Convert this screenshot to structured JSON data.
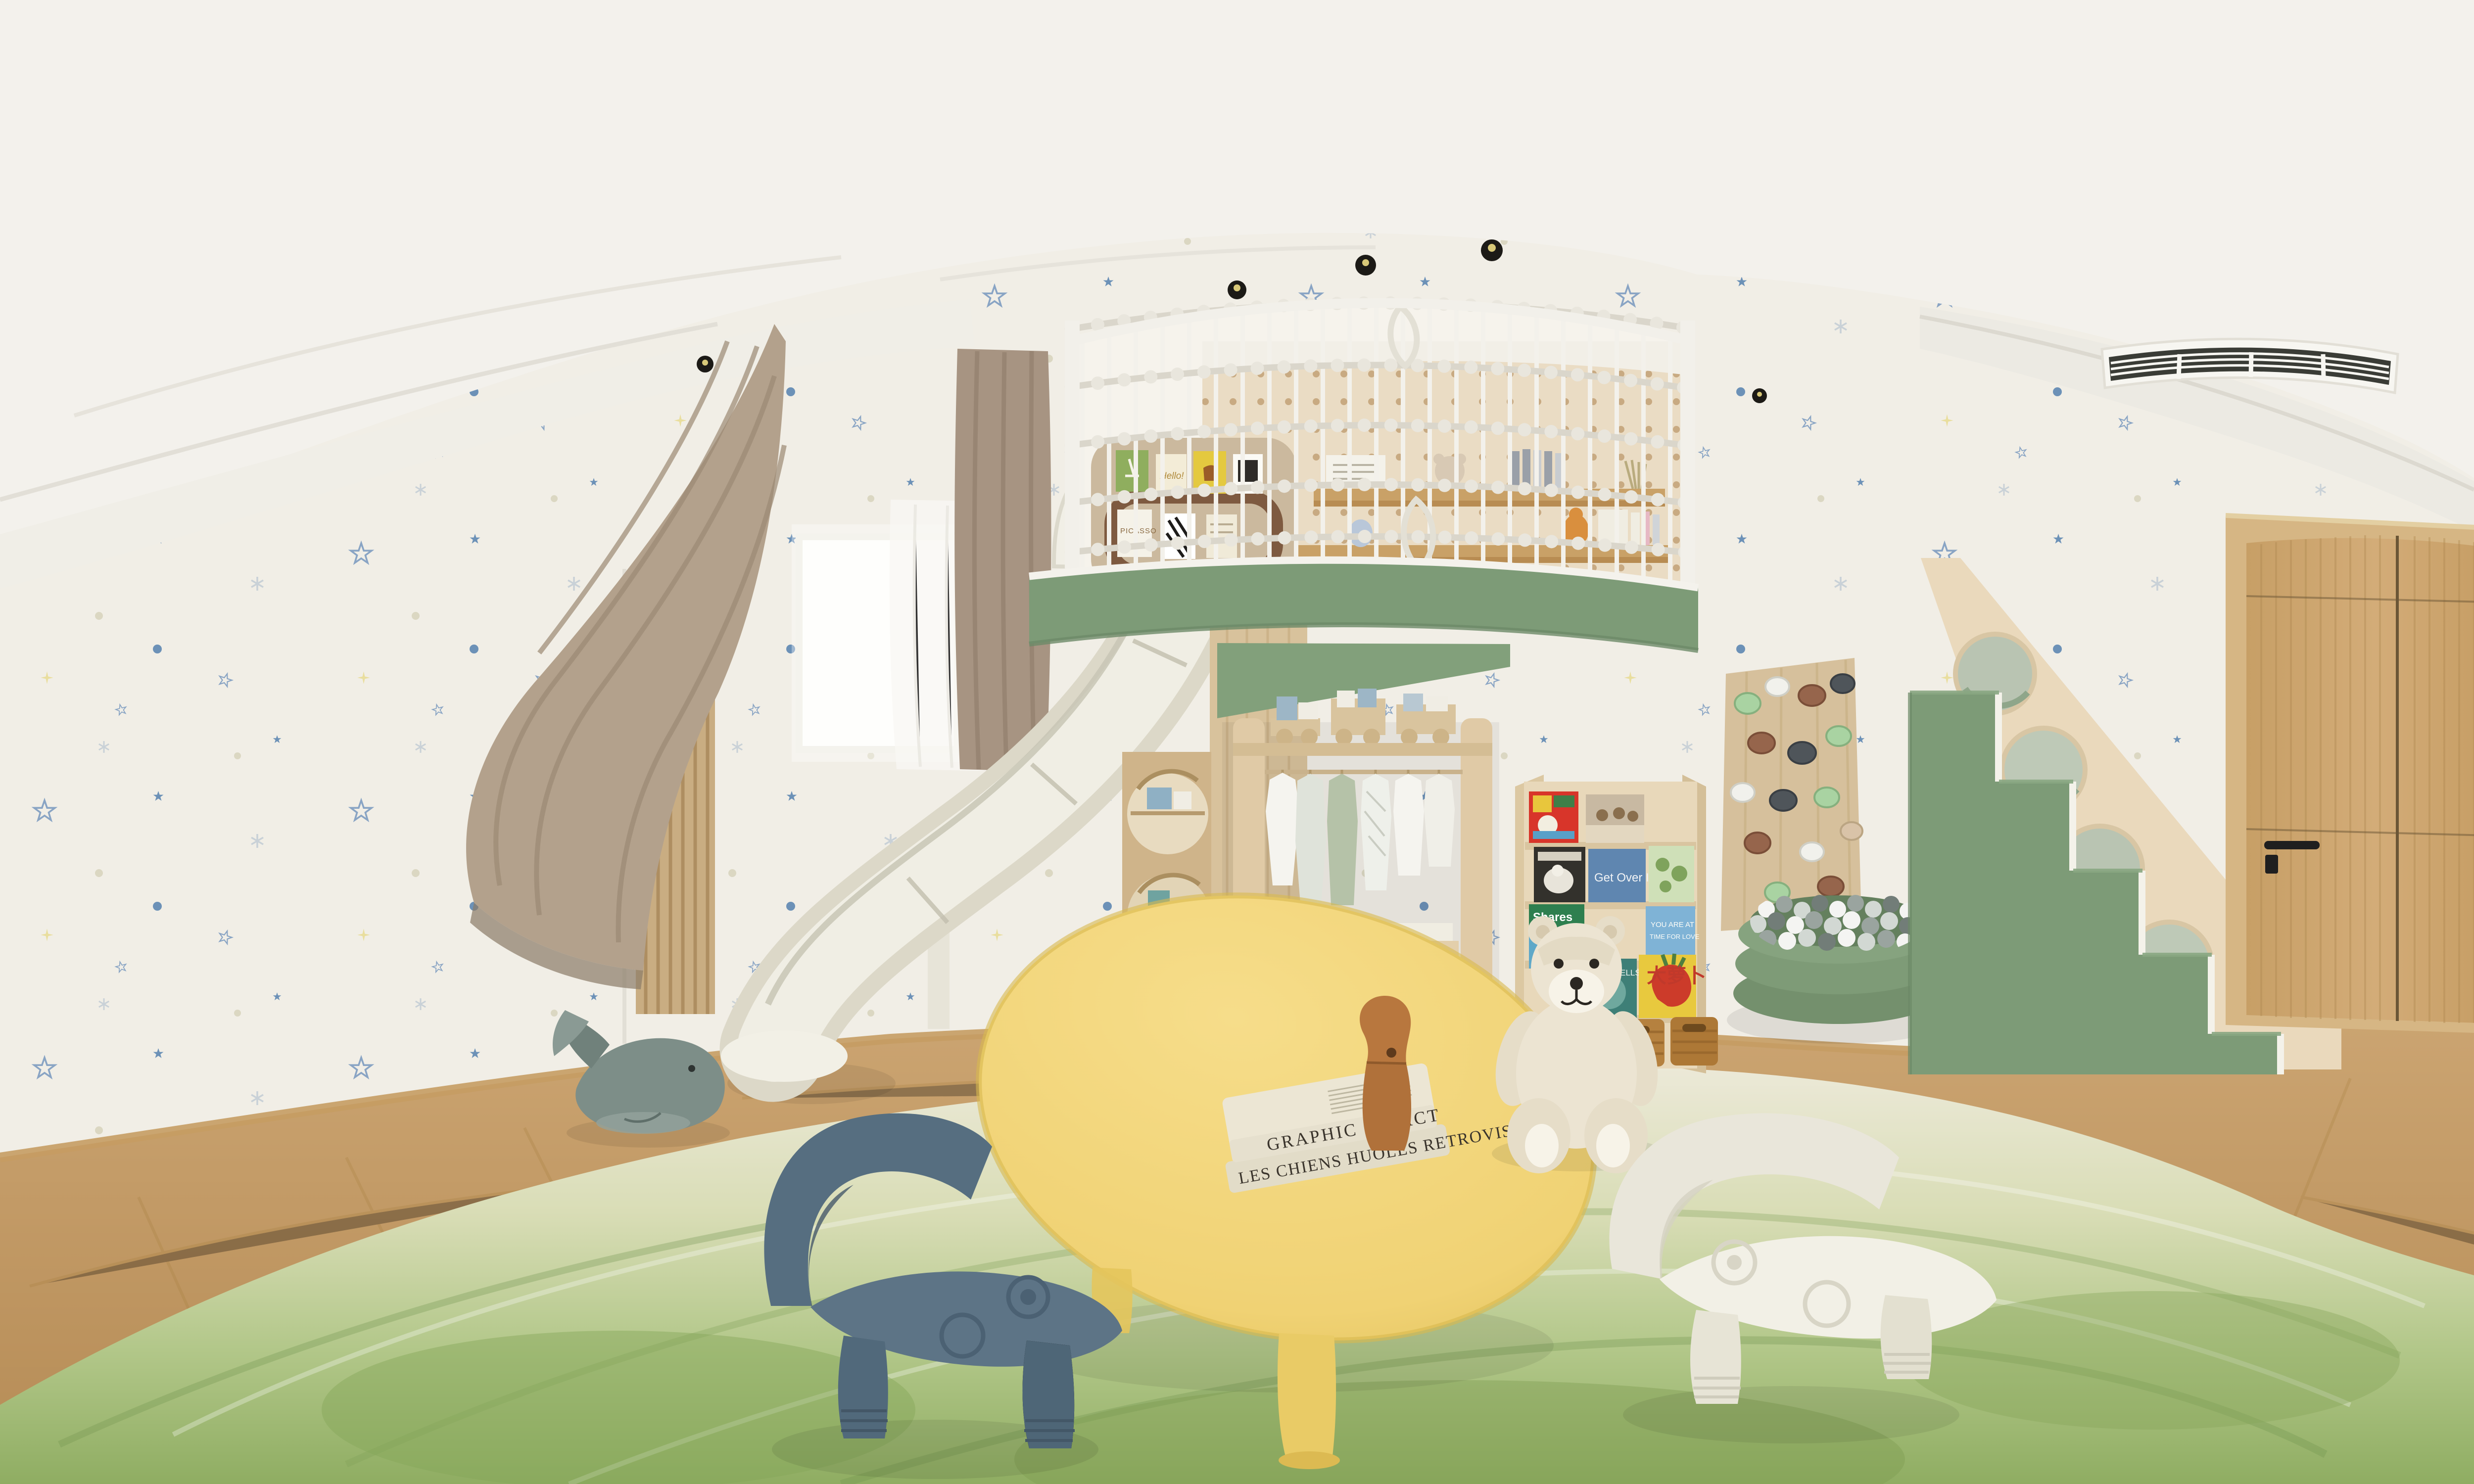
{
  "scene": {
    "kind": "equirectangular-360-panorama-render",
    "room": "children-playroom",
    "description": "360-degree render of a kids playroom: star wallpaper, loft play structure with rope-net railing, white slide, sage-green platform and staircase with porthole panel, open wardrobe with toy train, book display shelf, climbing wall, green ball pit, teddy bear, yellow play table with books, blue and white toddler chairs, green gradient rug, taupe curtains, window, oak door, ceiling AC grille and recessed spotlights"
  },
  "palette": {
    "ceiling": "#f3f1ec",
    "wall": "#f1eee6",
    "cove_band": "#f0eee7",
    "bulkhead": "#eceae3",
    "star_blue_outline": "#7d9cc0",
    "star_blue_solid": "#5d87b2",
    "star_gray": "#c5ced5",
    "star_yellow": "#e8dc96",
    "dot_beige": "#d9d4be",
    "floor_wood": "#c49a66",
    "floor_plank_line": "#a8803f",
    "baseboard": "#c59c63",
    "rug_cream": "#ece9d8",
    "rug_green": "#93b168",
    "sage_green": "#7d9b77",
    "sage_green_dark": "#6d8a68",
    "plywood": "#e8d9bc",
    "wood_furniture": "#e0caa6",
    "pegboard": "#eadcc4",
    "slide_white": "#efede3",
    "curtain_taupe": "#b3a18c",
    "sheer_white": "#f8f7f3",
    "door_oak": "#cfa873",
    "table_yellow": "#f0d274",
    "chair_blue": "#5d7486",
    "chair_white": "#f0eee4",
    "teddy_cream": "#ece4d2",
    "whale_gray_green": "#7d8e88",
    "wicker": "#b5813f",
    "vent_slat": "#3a3c36",
    "ball_white": "#f4f4f2",
    "ball_gray": "#9aa49f"
  },
  "objects": [
    {
      "name": "rope-net-railing",
      "color": "#f2f0ea",
      "note": "arched white loft balustrade, vertical rods with knotted ropes"
    },
    {
      "name": "pegboard-wall",
      "color": "#eadcc4",
      "note": "perforated plywood inside loft with shelves, books, plush toys"
    },
    {
      "name": "pinboard",
      "color": "#cbb99e",
      "note": "cork board with small cards"
    },
    {
      "name": "loft-fascia",
      "color": "#7d9b77"
    },
    {
      "name": "slide",
      "color": "#efede3"
    },
    {
      "name": "play-tower-porthole",
      "color": "#d8c29c"
    },
    {
      "name": "wardrobe-open",
      "color": "#e0caa6",
      "note": "toy train on top, hanging kids clothes, storage boxes"
    },
    {
      "name": "book-display-shelf",
      "color": "#e8d8ba",
      "note": "colorful picture books, wicker baskets"
    },
    {
      "name": "climbing-wall",
      "color": "#d6c09c",
      "note": "mint, white, brown and charcoal holds"
    },
    {
      "name": "ball-pit",
      "color": "#7e9b77",
      "note": "gray and white balls"
    },
    {
      "name": "staircase",
      "color": "#7d9b77",
      "note": "green steps, plywood side with four portholes"
    },
    {
      "name": "door-oak",
      "color": "#cfa873",
      "note": "black lever handle"
    },
    {
      "name": "ac-vent",
      "color": "#f7f6f1"
    },
    {
      "name": "ceiling-spotlights",
      "count": 5
    },
    {
      "name": "play-table-yellow",
      "color": "#f0d274",
      "note": "two books and wooden sculpture on top"
    },
    {
      "name": "toddler-chair-blue",
      "color": "#5d7486"
    },
    {
      "name": "toddler-chair-white",
      "color": "#f0eee4"
    },
    {
      "name": "teddy-bear",
      "color": "#ece4d2"
    },
    {
      "name": "whale-plush",
      "color": "#7d8e88"
    },
    {
      "name": "curtains",
      "color": "#b3a18c"
    },
    {
      "name": "window",
      "color": "#ffffff"
    },
    {
      "name": "rug-green-gradient",
      "color": "#93b168"
    }
  ],
  "texts": {
    "table_book_top_spine": "GRAPHIC IMPACT",
    "table_book_bottom_spine": "LES CHIENS HUOLES RETROVISEUR",
    "shelf_book_get_over_it": "Get Over It",
    "shelf_book_shares_line1": "Shares",
    "shelf_book_shares_line2": "Super Simple",
    "shelf_book_cells": "YOUR CELLS",
    "shelf_book_radish": "大萝卜",
    "shelf_book_love_line1": "YOU ARE AT",
    "shelf_book_love_line2": "TIME FOR LOVE",
    "pinboard_hello": "Hello!",
    "pinboard_picasso": "PICASSO"
  }
}
